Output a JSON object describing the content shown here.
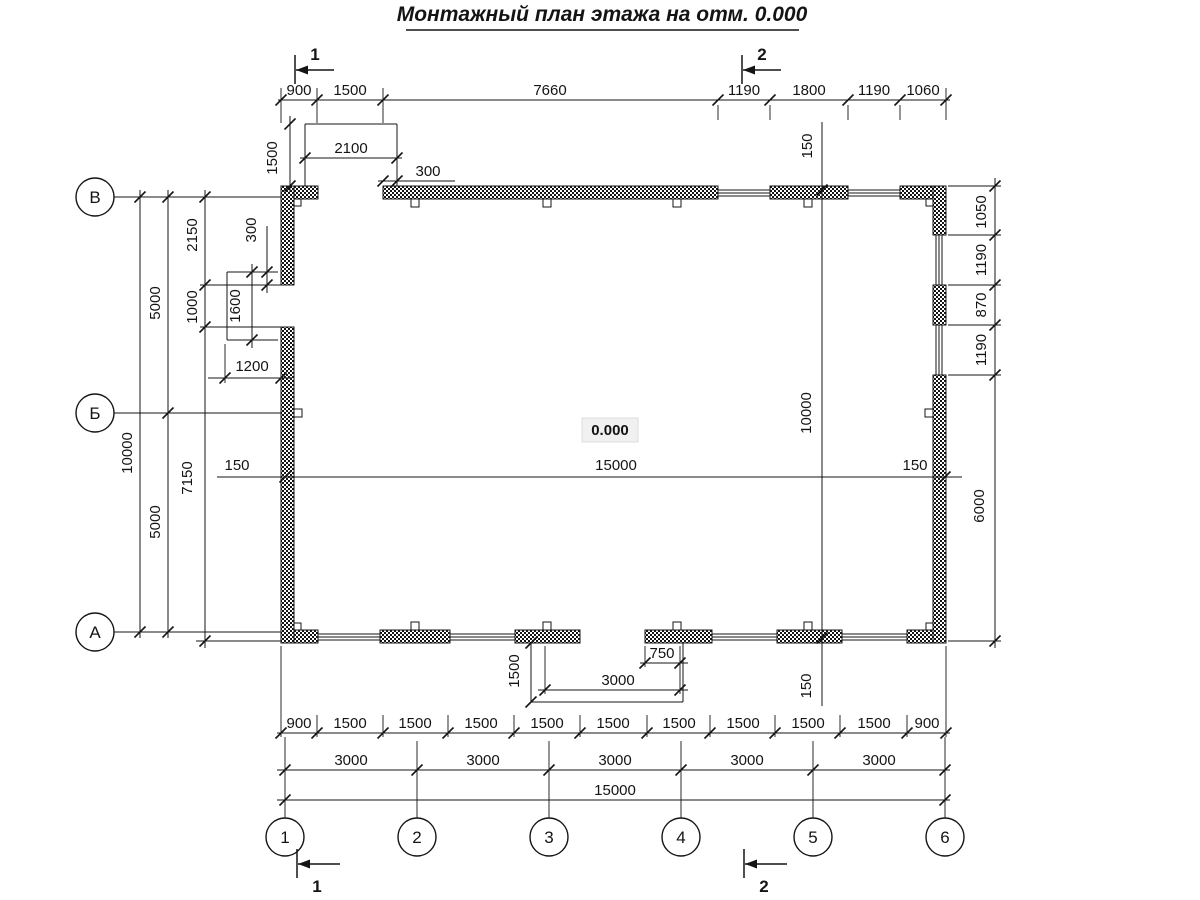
{
  "title": "Монтажный план этажа на отм. 0.000",
  "elevation": "0.000",
  "axes": {
    "rows": [
      "В",
      "Б",
      "А"
    ],
    "cols": [
      "1",
      "2",
      "3",
      "4",
      "5",
      "6"
    ]
  },
  "sections": {
    "cut1": "1",
    "cut2": "2"
  },
  "dims": {
    "top_chain": [
      "900",
      "1500",
      "7660",
      "1190",
      "1800",
      "1190",
      "1060"
    ],
    "top_porch": {
      "width": "2100",
      "depth": "1500",
      "offset": "300"
    },
    "left_outer": {
      "total": "10000",
      "span_top": "5000",
      "span_bottom": "5000",
      "seg_top": "2150",
      "seg_mid": "1000",
      "seg_bottom": "7150"
    },
    "left_porch": {
      "height": "1600",
      "offset": "300",
      "width": "1200"
    },
    "interior": {
      "width": "15000",
      "height": "10000",
      "off_left": "150",
      "off_right": "150",
      "off_top": "150",
      "off_bottom": "150"
    },
    "right_outer": [
      "1050",
      "1190",
      "870",
      "1190",
      "6000"
    ],
    "bottom_porch": {
      "depth": "1500",
      "offset": "750",
      "width": "3000"
    },
    "bottom_chain_fine": [
      "900",
      "1500",
      "1500",
      "1500",
      "1500",
      "1500",
      "1500",
      "1500",
      "1500",
      "1500",
      "900"
    ],
    "bottom_chain_main": [
      "3000",
      "3000",
      "3000",
      "3000",
      "3000"
    ],
    "bottom_total": "15000"
  }
}
